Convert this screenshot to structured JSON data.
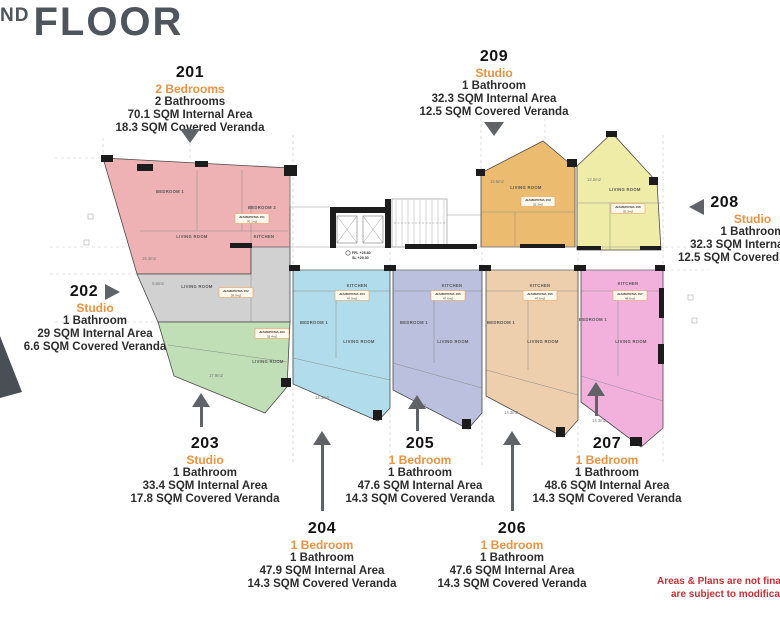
{
  "title": {
    "sup": "ND",
    "main": "FLOOR"
  },
  "units": {
    "u201": {
      "number": "201",
      "type": "2 Bedrooms",
      "bathrooms": "2 Bathrooms",
      "internal": "70.1 SQM Internal Area",
      "veranda": "18.3 SQM Covered Veranda"
    },
    "u202": {
      "number": "202",
      "type": "Studio",
      "bathrooms": "1 Bathroom",
      "internal": "29 SQM Internal Area",
      "veranda": "6.6 SQM Covered Veranda"
    },
    "u203": {
      "number": "203",
      "type": "Studio",
      "bathrooms": "1 Bathroom",
      "internal": "33.4 SQM Internal Area",
      "veranda": "17.8 SQM Covered Veranda"
    },
    "u204": {
      "number": "204",
      "type": "1 Bedroom",
      "bathrooms": "1 Bathroom",
      "internal": "47.9 SQM Internal Area",
      "veranda": "14.3 SQM Covered Veranda"
    },
    "u205": {
      "number": "205",
      "type": "1 Bedroom",
      "bathrooms": "1 Bathroom",
      "internal": "47.6 SQM Internal Area",
      "veranda": "14.3 SQM Covered Veranda"
    },
    "u206": {
      "number": "206",
      "type": "1 Bedroom",
      "bathrooms": "1 Bathroom",
      "internal": "47.6 SQM Internal Area",
      "veranda": "14.3 SQM Covered Veranda"
    },
    "u207": {
      "number": "207",
      "type": "1 Bedroom",
      "bathrooms": "1 Bathroom",
      "internal": "48.6 SQM Internal Area",
      "veranda": "14.3 SQM Covered Veranda"
    },
    "u208": {
      "number": "208",
      "type": "Studio",
      "bathrooms": "1 Bathroom",
      "internal": "32.3 SQM Internal Area",
      "veranda": "12.5 SQM Covered Veranda"
    },
    "u209": {
      "number": "209",
      "type": "Studio",
      "bathrooms": "1 Bathroom",
      "internal": "32.3 SQM Internal Area",
      "veranda": "12.5 SQM Covered Veranda"
    }
  },
  "disclaimer": {
    "line1": "Areas & Plans are not final",
    "line2": "are subject to modificatio"
  },
  "plan": {
    "colors": {
      "u201": "#ecaaad",
      "u202": "#cccccc",
      "u203": "#b9dcae",
      "u204": "#a8d8e9",
      "u205": "#b3b9da",
      "u206": "#eccaa4",
      "u207": "#f1a9d9",
      "u208": "#edea9f",
      "u209": "#e9b55f",
      "accent_orange": "#ed9240",
      "disclaimer_red": "#c62f36",
      "arrow_gray": "#5f6368",
      "title_gray": "#4e555c"
    },
    "level_marker": {
      "line1": "FFL +25.80",
      "line2": "SL +29.30"
    },
    "room_labels": [
      "BEDROOM 1",
      "BEDROOM 2",
      "LIVING ROOM",
      "KITCHEN",
      "LIVING ROOM",
      "LIVING ROOM",
      "KITCHEN",
      "BEDROOM 1",
      "LIVING ROOM",
      "KITCHEN",
      "BEDROOM 1",
      "LIVING ROOM",
      "KITCHEN",
      "BEDROOM 1",
      "LIVING ROOM",
      "KITCHEN",
      "BEDROOM 1",
      "LIVING ROOM",
      "LIVING ROOM",
      "LIVING ROOM"
    ],
    "area_labels": [
      "19.3m2",
      "5.6m2",
      "17.9m2",
      "14.3m2",
      "14.3m2",
      "14.3m2",
      "14.3m2",
      "12.5m2",
      "12.5m2"
    ],
    "unit_tags": [
      {
        "name": "ΔΙΑΜΕΡΙΣΜΑ 201",
        "area": "70.1m2"
      },
      {
        "name": "ΔΙΑΜΕΡΙΣΜΑ 202",
        "area": "29.0m2"
      },
      {
        "name": "ΔΙΑΜΕΡΙΣΜΑ 203",
        "area": "33.4m2"
      },
      {
        "name": "ΔΙΑΜΕΡΙΣΜΑ 204",
        "area": "47.9m2"
      },
      {
        "name": "ΔΙΑΜΕΡΙΣΜΑ 205",
        "area": "47.6m2"
      },
      {
        "name": "ΔΙΑΜΕΡΙΣΜΑ 206",
        "area": "47.6m2"
      },
      {
        "name": "ΔΙΑΜΕΡΙΣΜΑ 207",
        "area": "48.6m2"
      },
      {
        "name": "ΔΙΑΜΕΡΙΣΜΑ 208",
        "area": "32.3m2"
      },
      {
        "name": "ΔΙΑΜΕΡΙΣΜΑ 209",
        "area": "32.3m2"
      }
    ]
  }
}
